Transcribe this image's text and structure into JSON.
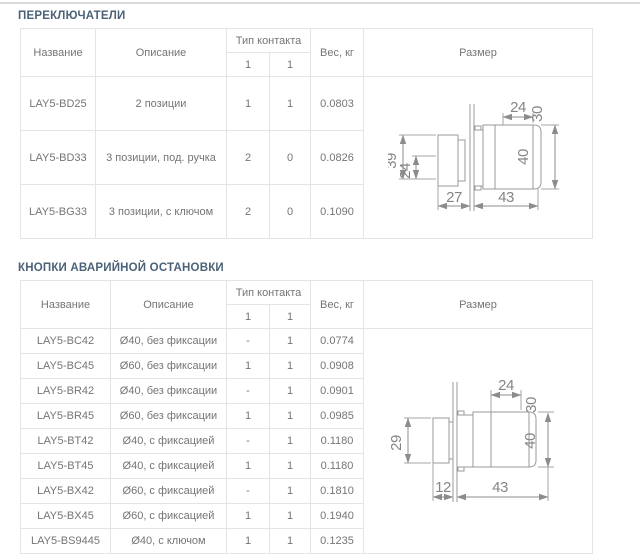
{
  "page": {
    "colors": {
      "title_text": "#4c6278",
      "body_text": "#757575",
      "table_border": "#e4e4e4",
      "drawing_lines": "#9a9a9a"
    }
  },
  "switches": {
    "title": "ПЕРЕКЛЮЧАТЕЛИ",
    "headers": {
      "name": "Название",
      "description": "Описание",
      "contact_type": "Тип контакта",
      "sub1": "1",
      "sub2": "1",
      "weight": "Вес, кг",
      "size": "Размер"
    },
    "rows": [
      {
        "name": "LAY5-BD25",
        "description": "2 позиции",
        "c1": "1",
        "c2": "1",
        "weight": "0.0803"
      },
      {
        "name": "LAY5-BD33",
        "description": "3 позиции, под. ручка",
        "c1": "2",
        "c2": "0",
        "weight": "0.0826"
      },
      {
        "name": "LAY5-BG33",
        "description": "3 позиции, с ключом",
        "c1": "2",
        "c2": "0",
        "weight": "0.1090"
      }
    ],
    "drawing": {
      "left_outer": "39",
      "left_inner": "24",
      "top": "24",
      "top_right": "30",
      "right": "40",
      "bottom_left": "27",
      "bottom_right": "43"
    }
  },
  "estop": {
    "title": "КНОПКИ АВАРИЙНОЙ ОСТАНОВКИ",
    "headers": {
      "name": "Название",
      "description": "Описание",
      "contact_type": "Тип контакта",
      "sub1": "1",
      "sub2": "1",
      "weight": "Вес, кг",
      "size": "Размер"
    },
    "rows": [
      {
        "name": "LAY5-BC42",
        "description": "Ø40, без фиксации",
        "c1": "-",
        "c2": "1",
        "weight": "0.0774"
      },
      {
        "name": "LAY5-BC45",
        "description": "Ø60, без фиксации",
        "c1": "1",
        "c2": "1",
        "weight": "0.0908"
      },
      {
        "name": "LAY5-BR42",
        "description": "Ø40, без фиксации",
        "c1": "-",
        "c2": "1",
        "weight": "0.0901"
      },
      {
        "name": "LAY5-BR45",
        "description": "Ø60, без фиксации",
        "c1": "1",
        "c2": "1",
        "weight": "0.0985"
      },
      {
        "name": "LAY5-BT42",
        "description": "Ø40, с фиксацией",
        "c1": "-",
        "c2": "1",
        "weight": "0.1180"
      },
      {
        "name": "LAY5-BT45",
        "description": "Ø40, с фиксацией",
        "c1": "1",
        "c2": "1",
        "weight": "0.1180"
      },
      {
        "name": "LAY5-BX42",
        "description": "Ø60, с фиксацией",
        "c1": "-",
        "c2": "1",
        "weight": "0.1810"
      },
      {
        "name": "LAY5-BX45",
        "description": "Ø60, с фиксацией",
        "c1": "1",
        "c2": "1",
        "weight": "0.1940"
      },
      {
        "name": "LAY5-BS9445",
        "description": "Ø40, с ключом",
        "c1": "1",
        "c2": "1",
        "weight": "0.1235"
      }
    ],
    "drawing": {
      "left_outer": "29",
      "top": "24",
      "top_right": "30",
      "right": "40",
      "bottom_left": "12",
      "bottom_right": "43"
    }
  }
}
